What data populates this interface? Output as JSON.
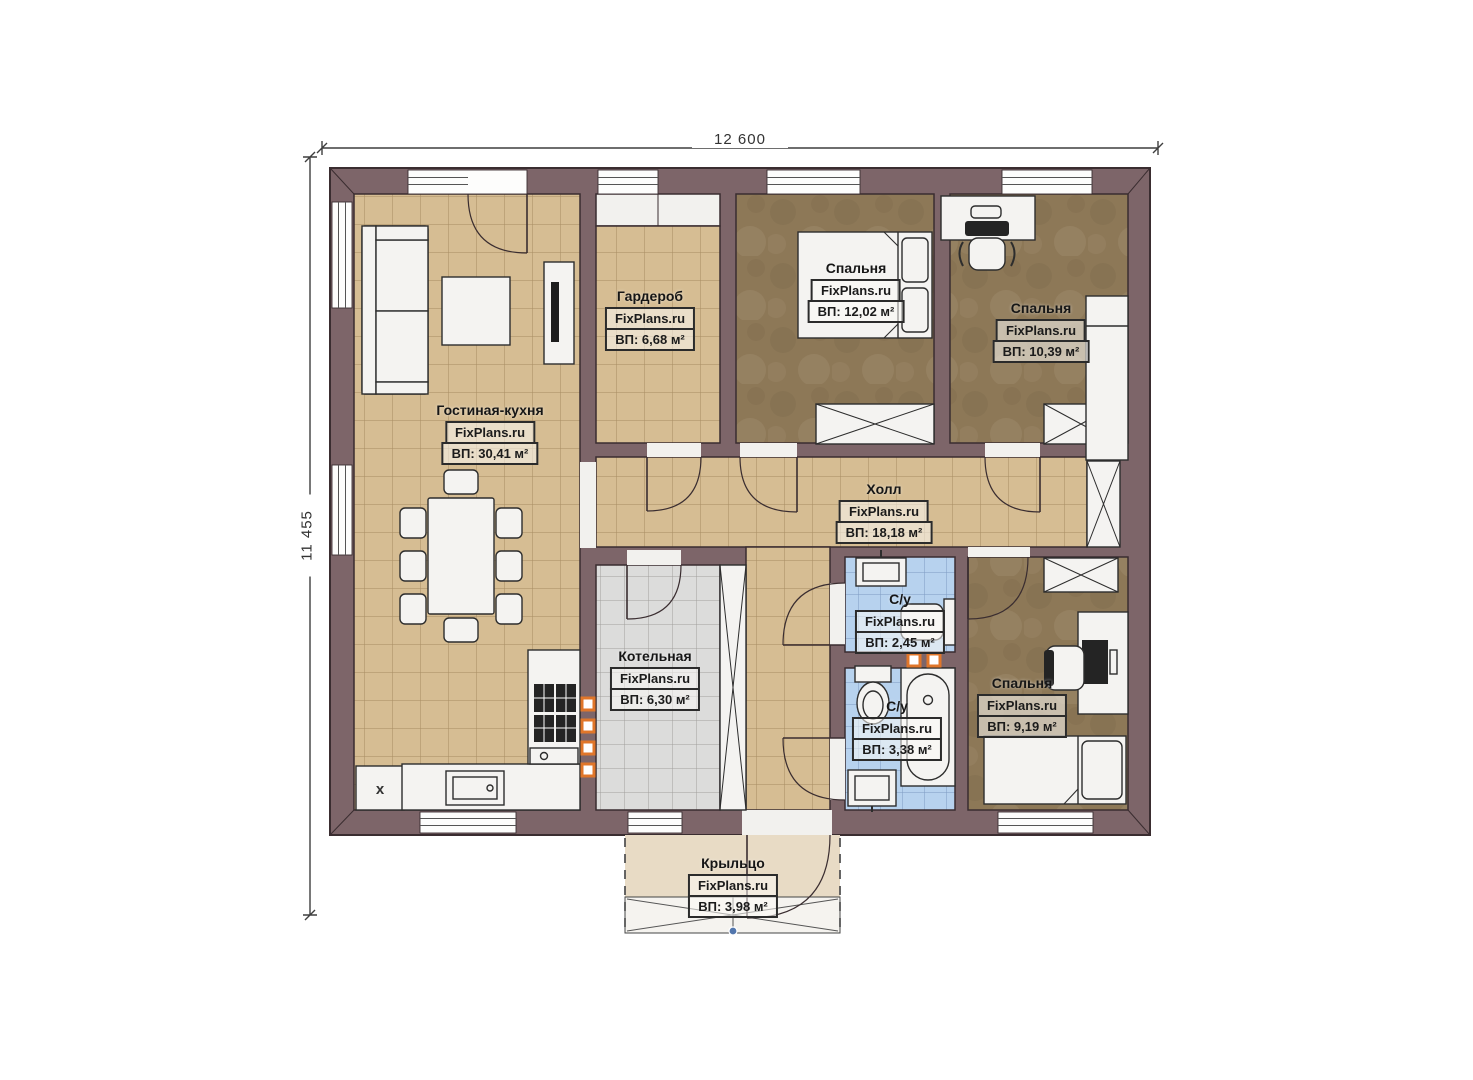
{
  "dimensions": {
    "width_label": "12 600",
    "height_label": "11 455"
  },
  "watermark": "FixPlans.ru",
  "rooms": [
    {
      "key": "living",
      "name": "Гостиная-кухня",
      "area": "ВП: 30,41 м²"
    },
    {
      "key": "wardrobe",
      "name": "Гардероб",
      "area": "ВП: 6,68 м²"
    },
    {
      "key": "bedroom-1",
      "name": "Спальня",
      "area": "ВП: 12,02 м²"
    },
    {
      "key": "bedroom-2",
      "name": "Спальня",
      "area": "ВП: 10,39 м²"
    },
    {
      "key": "hall",
      "name": "Холл",
      "area": "ВП: 18,18 м²"
    },
    {
      "key": "boiler",
      "name": "Котельная",
      "area": "ВП: 6,30 м²"
    },
    {
      "key": "wc-1",
      "name": "С/у",
      "area": "ВП: 2,45 м²"
    },
    {
      "key": "wc-2",
      "name": "С/у",
      "area": "ВП: 3,38 м²"
    },
    {
      "key": "bedroom-3",
      "name": "Спальня",
      "area": "ВП: 9,19 м²"
    },
    {
      "key": "porch",
      "name": "Крыльцо",
      "area": "ВП: 3,98 м²"
    }
  ],
  "markers": {
    "kitchen_x": "x"
  },
  "colors": {
    "wall": "#7d6569",
    "wall_outline": "#3a2d30",
    "floor_tile_tan": "#d6bd93",
    "floor_bedroom_brown": "#8d7857",
    "floor_boiler_gray": "#dcdcdb",
    "floor_bath_blue": "#b7d2ee",
    "floor_porch": "#e8dbc5",
    "accent_orange": "#e0762a",
    "step_dot_blue": "#5276ad"
  }
}
